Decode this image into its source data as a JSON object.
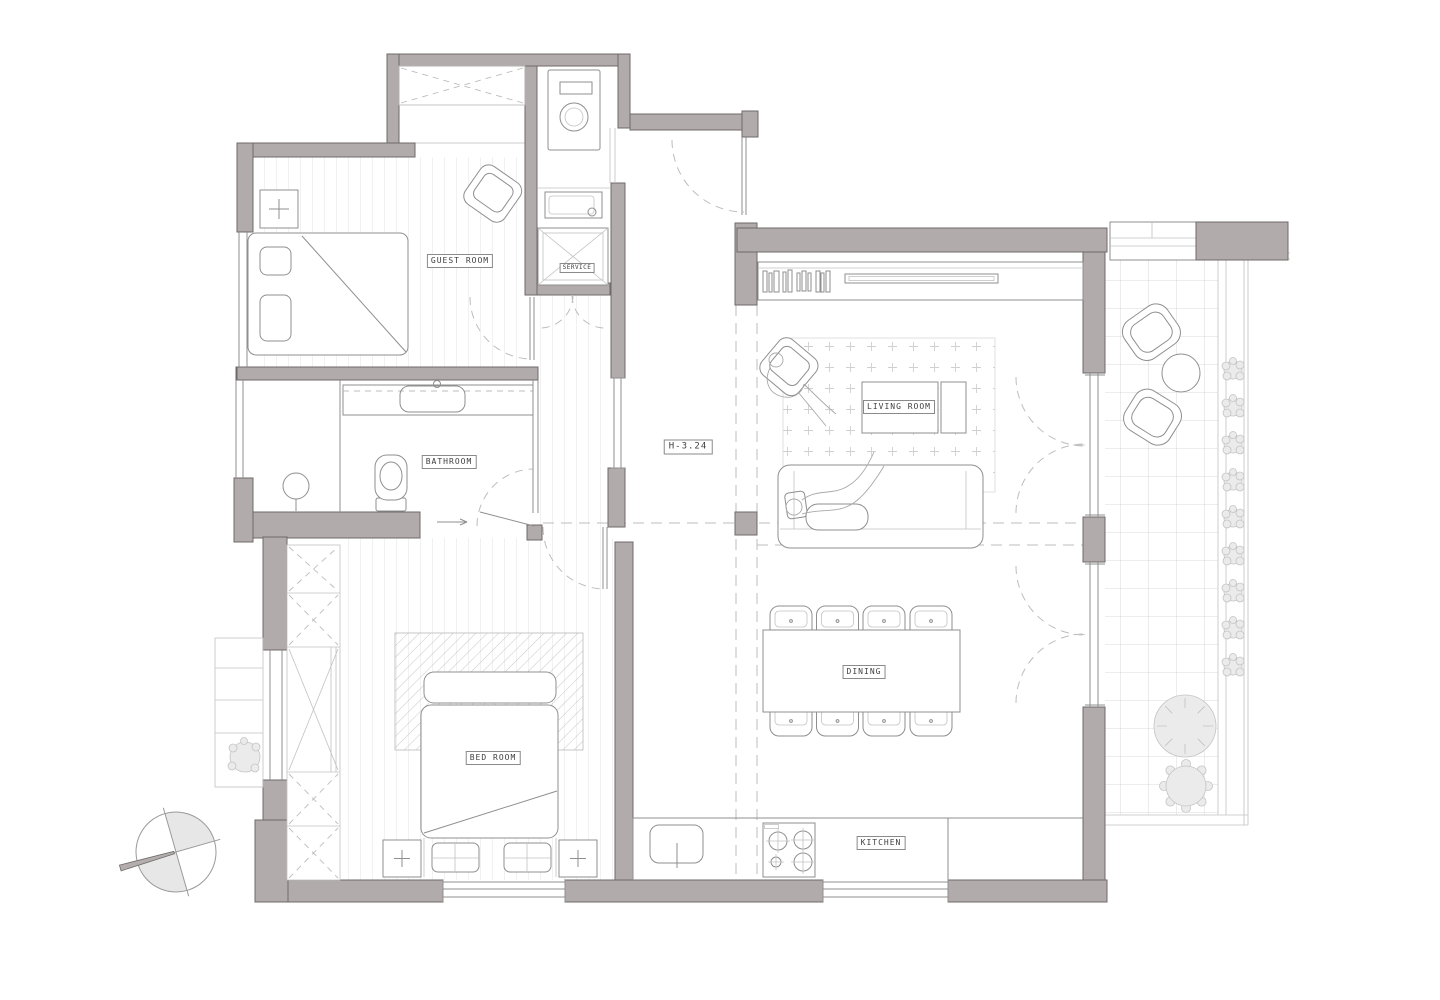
{
  "rooms": {
    "guest_room": {
      "label": "GUEST ROOM"
    },
    "service": {
      "label": "SERVICE"
    },
    "bathroom": {
      "label": "BATHROOM"
    },
    "bed_room": {
      "label": "BED ROOM"
    },
    "living_room": {
      "label": "LIVING ROOM"
    },
    "dining": {
      "label": "DINING"
    },
    "kitchen": {
      "label": "KITCHEN"
    }
  },
  "annotations": {
    "ceiling_height": "H-3.24"
  },
  "colors": {
    "wall_fill": "#b1abab",
    "wall_stroke": "#6f6a6a",
    "line": "#8f8f8f",
    "line_light": "#c2c2c2",
    "floor_line": "#dcdcdc",
    "dashed": "#bdbdbd",
    "plant_fill": "#ebebeb",
    "paper": "#ffffff"
  }
}
